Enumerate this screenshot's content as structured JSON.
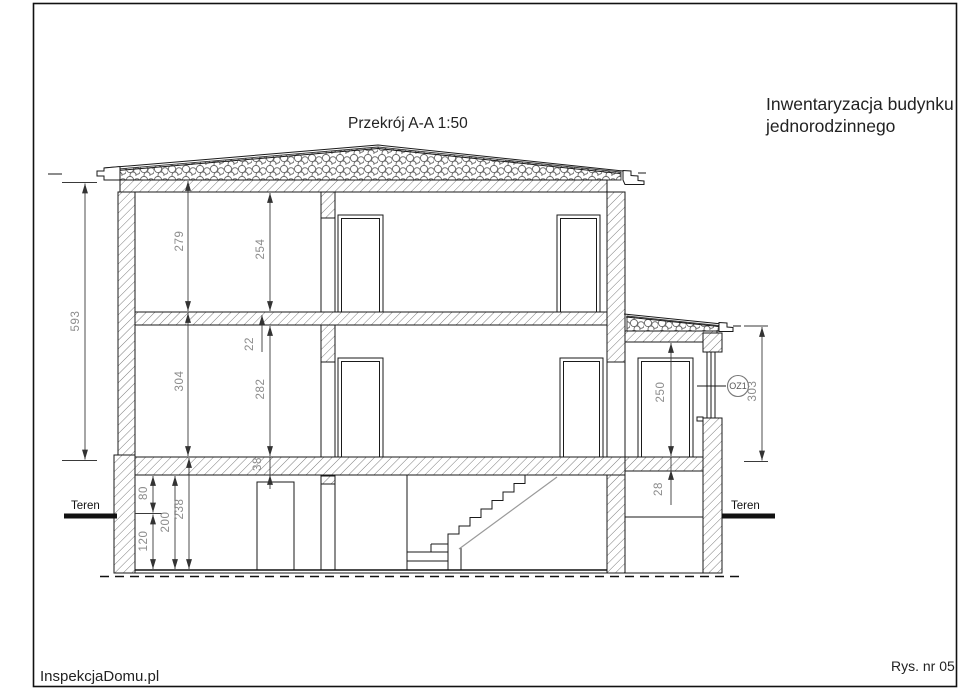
{
  "page": {
    "drawing_title": "Przekrój A-A  1:50",
    "project_title_line1": "Inwentaryzacja budynku",
    "project_title_line2": "jednorodzinnego",
    "company": "InspekcjaDomu.pl",
    "sheet_number": "Rys. nr 05"
  },
  "section": {
    "ground_label_left": "Teren",
    "ground_label_right": "Teren",
    "window_tag": "OZ1",
    "dimensions_cm": {
      "overall_height": "593",
      "second_floor_with_slab": "279",
      "second_floor_clear": "254",
      "slab_thickness": "22",
      "first_floor_with_slab": "304",
      "first_floor_clear": "282",
      "ground_slab_thickness": "38",
      "slab_to_ground": "80",
      "slab_to_floor": "200",
      "ground_to_floor": "120",
      "basement_clear": "238",
      "annex_clear": "250",
      "annex_slab_thickness": "28",
      "annex_height": "303"
    }
  }
}
